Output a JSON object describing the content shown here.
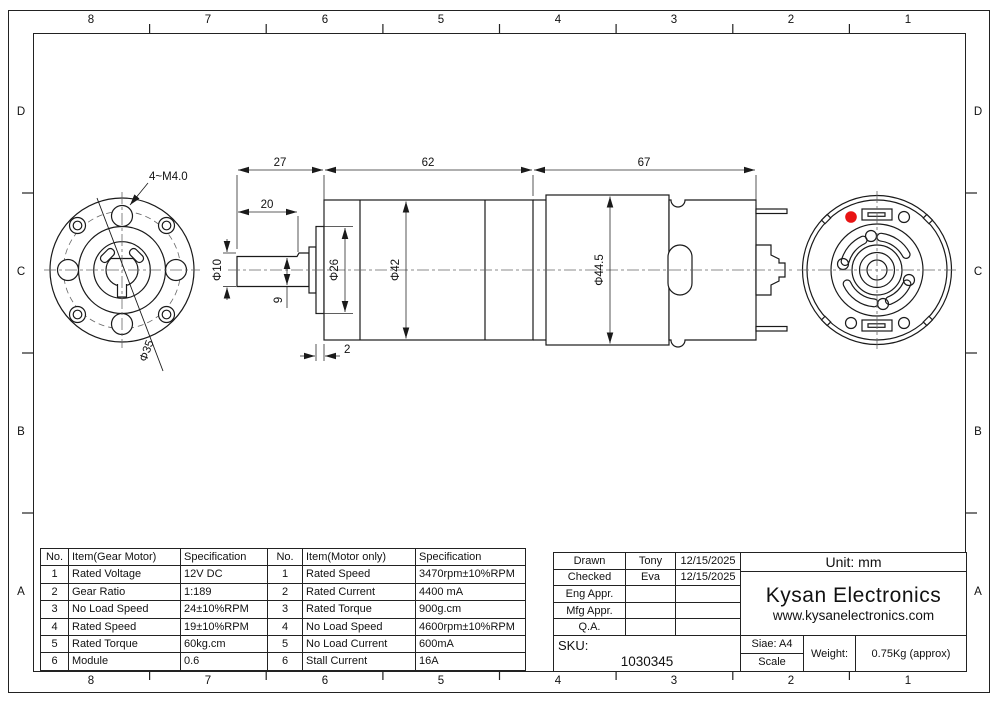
{
  "drawing": {
    "zone_cols": [
      "8",
      "7",
      "6",
      "5",
      "4",
      "3",
      "2",
      "1"
    ],
    "zone_rows": [
      "D",
      "C",
      "B",
      "A"
    ],
    "labels": {
      "shaft_length": "27",
      "flat_length": "20",
      "gearbox_length": "62",
      "motor_length": "67",
      "shaft_diameter": "Φ10",
      "shaft_flat": "9",
      "plate_thickness": "2",
      "front_boss_diameter": "Φ26",
      "gearbox_diameter": "Φ42",
      "motor_diameter": "Φ44.5",
      "mounting_holes": "4~M4.0",
      "bolt_circle": "Φ35"
    }
  },
  "gear_table": {
    "col_no": "No.",
    "col_item": "Item(Gear Motor)",
    "col_spec": "Specification",
    "rows": [
      [
        "1",
        "Rated Voltage",
        "12V DC"
      ],
      [
        "2",
        "Gear Ratio",
        "1:189"
      ],
      [
        "3",
        "No Load Speed",
        "24±10%RPM"
      ],
      [
        "4",
        "Rated Speed",
        "19±10%RPM"
      ],
      [
        "5",
        "Rated Torque",
        "60kg.cm"
      ],
      [
        "6",
        "Module",
        "0.6"
      ]
    ]
  },
  "motor_table": {
    "col_no": "No.",
    "col_item": "Item(Motor only)",
    "col_spec": "Specification",
    "rows": [
      [
        "1",
        "Rated Speed",
        "3470rpm±10%RPM"
      ],
      [
        "2",
        "Rated Current",
        "4400 mA"
      ],
      [
        "3",
        "Rated Torque",
        "900g.cm"
      ],
      [
        "4",
        "No Load Speed",
        "4600rpm±10%RPM"
      ],
      [
        "5",
        "No Load Current",
        "600mA"
      ],
      [
        "6",
        "Stall Current",
        "16A"
      ]
    ]
  },
  "title_block": {
    "rows": [
      {
        "label": "Drawn",
        "name": "Tony",
        "date": "12/15/2025"
      },
      {
        "label": "Checked",
        "name": "Eva",
        "date": "12/15/2025"
      },
      {
        "label": "Eng Appr.",
        "name": "",
        "date": ""
      },
      {
        "label": "Mfg Appr.",
        "name": "",
        "date": ""
      },
      {
        "label": "Q.A.",
        "name": "",
        "date": ""
      }
    ],
    "sku_label": "SKU:",
    "sku_value": "1030345",
    "unit": "Unit: mm",
    "company": "Kysan Electronics",
    "website": "www.kysanelectronics.com",
    "size": "Siae: A4",
    "scale_label": "Scale",
    "weight_label": "Weight:",
    "weight_value": "0.75Kg (approx)"
  },
  "colors": {
    "line": "#1a1a1a",
    "centerline": "#666666",
    "marker_red": "#e81313"
  }
}
